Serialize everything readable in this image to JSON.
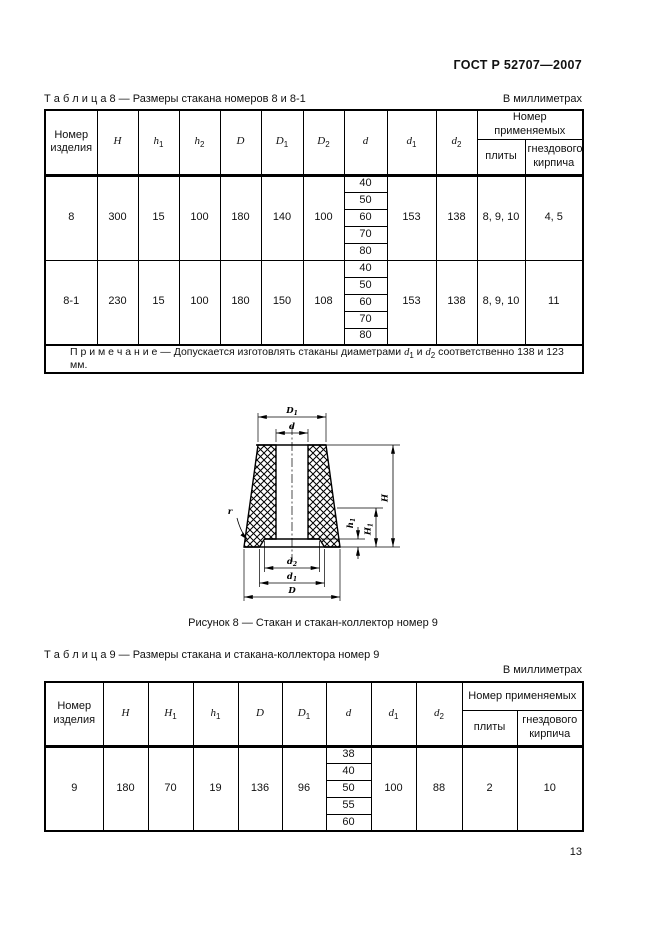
{
  "header": {
    "title": "ГОСТ Р 52707—2007"
  },
  "page_number": "13",
  "figure": {
    "caption": "Рисунок 8 —  Стакан и стакан-коллектор номер 9",
    "labels": {
      "D1": "D_1",
      "d": "d",
      "H": "H",
      "H1": "H_1",
      "h1": "h_1",
      "d2": "d_2",
      "d1": "d_1",
      "D": "D",
      "r": "r"
    }
  },
  "tables": [
    {
      "title": "Т а б л и ц а   8 — Размеры стакана номеров 8 и 8-1",
      "units": "В миллиметрах",
      "columns": {
        "first": "Номер изделия",
        "before_d": [
          "H",
          "h_1",
          "h_2",
          "D",
          "D_1",
          "D_2"
        ],
        "d": "d",
        "after_d": [
          "d_1",
          "d_2"
        ],
        "group": "Номер применяемых",
        "subs": [
          "плиты",
          "гнездового кирпича"
        ]
      },
      "rows": [
        {
          "item": "8",
          "before": [
            "300",
            "15",
            "100",
            "180",
            "140",
            "100"
          ],
          "d_values": [
            "40",
            "50",
            "60",
            "70",
            "80"
          ],
          "after": [
            "153",
            "138"
          ],
          "plates": "8, 9, 10",
          "brick": "4, 5"
        },
        {
          "item": "8-1",
          "before": [
            "230",
            "15",
            "100",
            "180",
            "150",
            "108"
          ],
          "d_values": [
            "40",
            "50",
            "60",
            "70",
            "80"
          ],
          "after": [
            "153",
            "138"
          ],
          "plates": "8, 9, 10",
          "brick": "11"
        }
      ],
      "note": "П р и м е ч а н и е — Допускается изготовлять стаканы диаметрами d_1 и d_2 соответственно 138 и 123 мм."
    },
    {
      "title": "Т а б л и ц а   9 —  Размеры стакана и стакана-коллектора номер 9",
      "units": "В миллиметрах",
      "columns": {
        "first": "Номер изделия",
        "before_d": [
          "H",
          "H_1",
          "h_1",
          "D",
          "D_1"
        ],
        "d": "d",
        "after_d": [
          "d_1",
          "d_2"
        ],
        "group": "Номер применяемых",
        "subs": [
          "плиты",
          "гнездового кирпича"
        ]
      },
      "rows": [
        {
          "item": "9",
          "before": [
            "180",
            "70",
            "19",
            "136",
            "96"
          ],
          "d_values": [
            "38",
            "40",
            "50",
            "55",
            "60"
          ],
          "after": [
            "100",
            "88"
          ],
          "plates": "2",
          "brick": "10"
        }
      ],
      "note": null
    }
  ]
}
